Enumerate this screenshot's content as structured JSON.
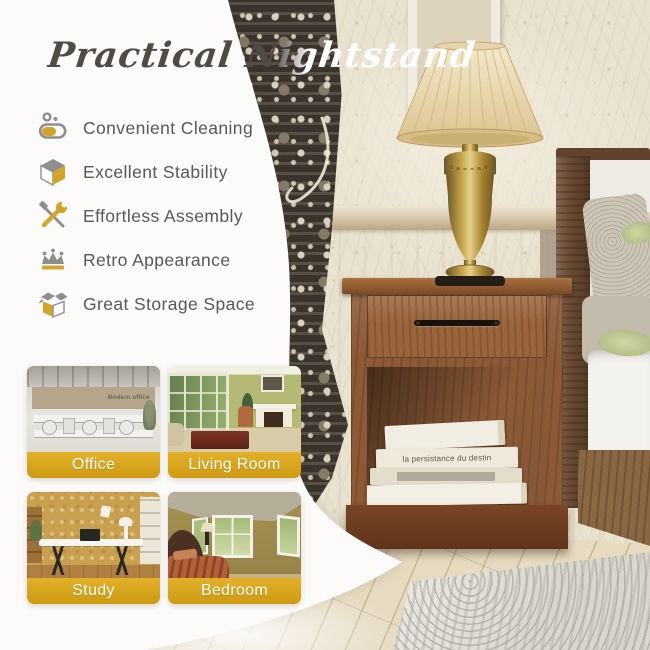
{
  "page": {
    "title": "Practical Nightstand"
  },
  "palette": {
    "accent_gold": "#d7a31d",
    "icon_gold": "#d2a42a",
    "icon_gray": "#8e8e8e",
    "title_gray": "#4f4b47",
    "feature_text": "#5a5755",
    "label_text": "#ffffff"
  },
  "features": {
    "items": [
      {
        "icon": "sponge-clean-icon",
        "label": "Convenient Cleaning"
      },
      {
        "icon": "cube-icon",
        "label": "Excellent Stability"
      },
      {
        "icon": "wrench-screwdriver-icon",
        "label": "Effortless Assembly"
      },
      {
        "icon": "crown-icon",
        "label": "Retro Appearance"
      },
      {
        "icon": "open-box-icon",
        "label": "Great Storage Space"
      }
    ]
  },
  "room_thumbnails": {
    "items": [
      {
        "label": "Office"
      },
      {
        "label": "Living Room"
      },
      {
        "label": "Study"
      },
      {
        "label": "Bedroom"
      }
    ]
  },
  "photo_scene": {
    "book_spine_text": "la persistance du destin",
    "office_wall_text": "Modern office"
  }
}
